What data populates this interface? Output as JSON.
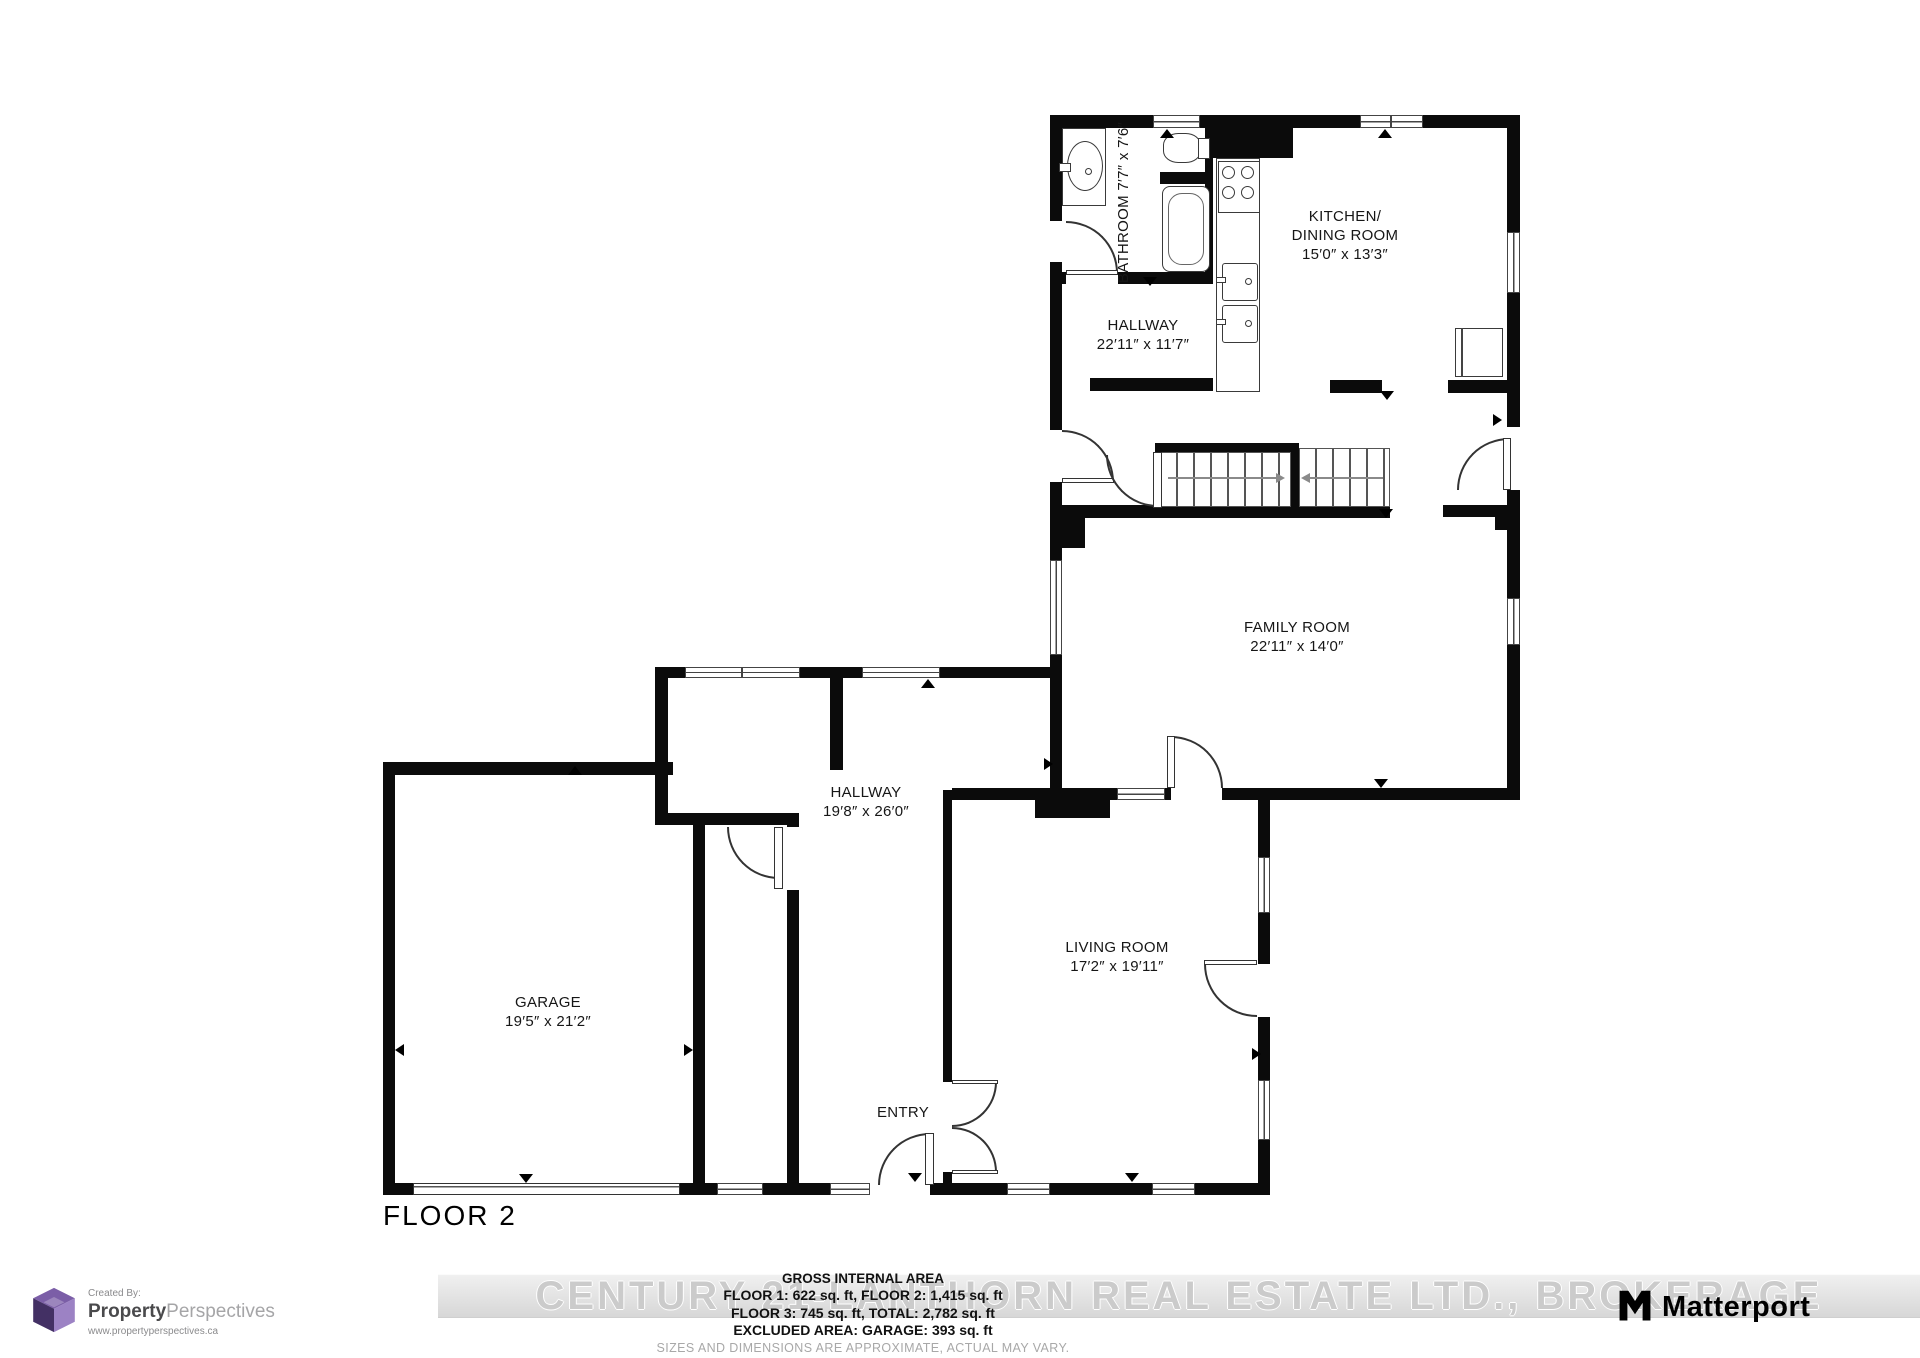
{
  "plan": {
    "floor_label": "FLOOR 2",
    "rooms": [
      {
        "id": "bathroom",
        "lines": [
          "BATHROOM",
          "7′7″ x 7′6″"
        ]
      },
      {
        "id": "hallway-upper",
        "lines": [
          "HALLWAY",
          "22′11″ x 11′7″"
        ]
      },
      {
        "id": "kitchen-dining",
        "lines": [
          "KITCHEN/",
          "DINING ROOM",
          "15′0″ x 13′3″"
        ]
      },
      {
        "id": "family-room",
        "lines": [
          "FAMILY ROOM",
          "22′11″ x 14′0″"
        ]
      },
      {
        "id": "hallway-lower",
        "lines": [
          "HALLWAY",
          "19′8″ x 26′0″"
        ]
      },
      {
        "id": "garage",
        "lines": [
          "GARAGE",
          "19′5″ x 21′2″"
        ]
      },
      {
        "id": "living-room",
        "lines": [
          "LIVING ROOM",
          "17′2″ x 19′11″"
        ]
      },
      {
        "id": "entry",
        "lines": [
          "ENTRY"
        ]
      }
    ]
  },
  "footer": {
    "watermark": "CENTURY 21-LANTHORN REAL ESTATE LTD., BROKERAGE",
    "area_title": "GROSS INTERNAL AREA",
    "area_line1": "FLOOR 1: 622 sq. ft, FLOOR 2: 1,415 sq. ft",
    "area_line2": "FLOOR 3: 745 sq. ft, TOTAL: 2,782 sq. ft",
    "area_line3": "EXCLUDED AREA: GARAGE: 393 sq. ft",
    "disclaimer": "SIZES AND DIMENSIONS ARE APPROXIMATE, ACTUAL MAY VARY."
  },
  "branding": {
    "created_by": "Created By:",
    "brand_bold": "Property",
    "brand_light": "Perspectives",
    "brand_url": "www.propertyperspectives.ca",
    "matterport": "Matterport"
  }
}
